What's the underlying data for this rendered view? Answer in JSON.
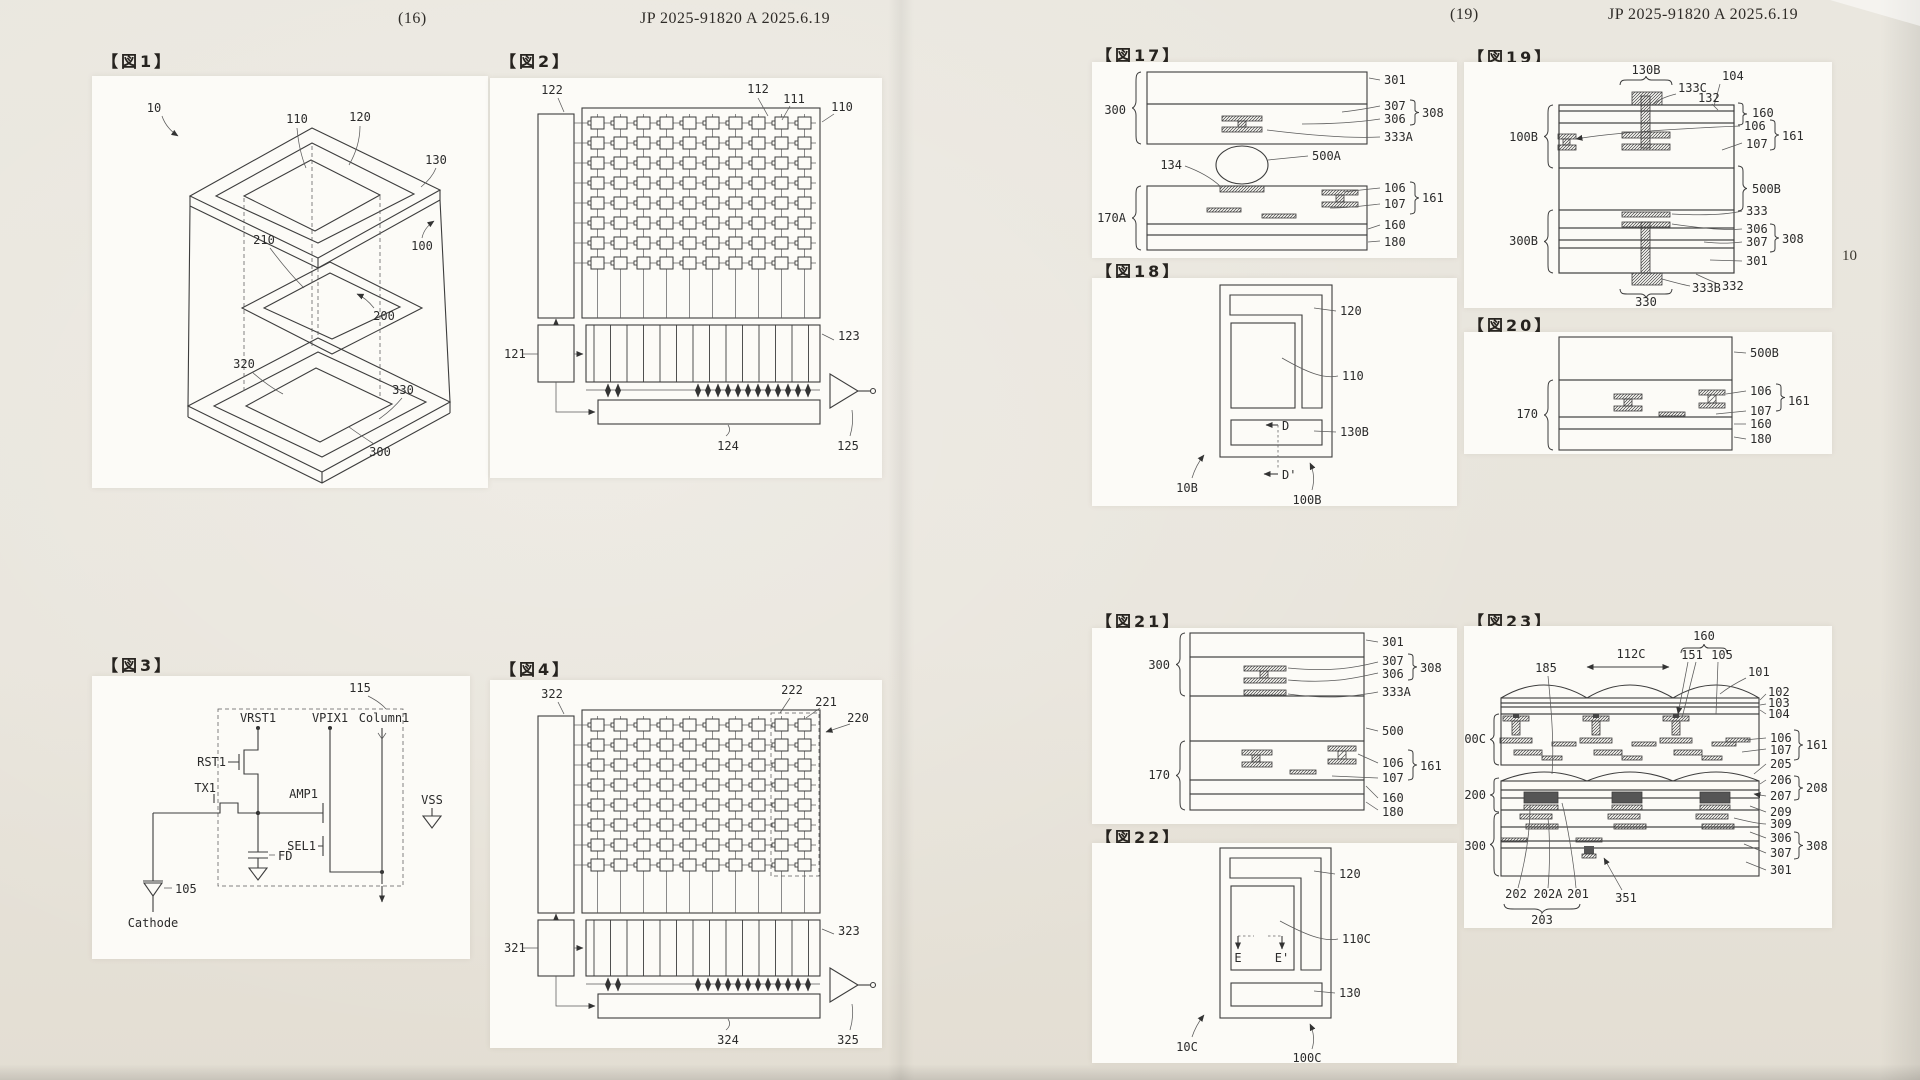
{
  "header_left": {
    "page_num": "(16)",
    "doc_id": "JP 2025-91820 A 2025.6.19"
  },
  "header_right": {
    "page_num": "(19)",
    "doc_id": "JP 2025-91820 A 2025.6.19"
  },
  "margin_note": "10",
  "figures": {
    "fig1": {
      "title": "【図1】",
      "labels": {
        "n10": "10",
        "n110": "110",
        "n120": "120",
        "n130": "130",
        "n100": "100",
        "n210": "210",
        "n200": "200",
        "n320": "320",
        "n330": "330",
        "n300": "300"
      }
    },
    "fig2": {
      "title": "【図2】",
      "labels": {
        "n122": "122",
        "n112": "112",
        "n111": "111",
        "n110": "110",
        "n121": "121",
        "n123": "123",
        "n124": "124",
        "n125": "125"
      }
    },
    "fig3": {
      "title": "【図3】",
      "labels": {
        "n115": "115",
        "vrst1": "VRST1",
        "vpix1": "VPIX1",
        "column1": "Column1",
        "rst1": "RST1",
        "tx1": "TX1",
        "amp1": "AMP1",
        "sel1": "SEL1",
        "fd": "FD",
        "vss": "VSS",
        "n105": "105",
        "cathode": "Cathode"
      }
    },
    "fig4": {
      "title": "【図4】",
      "labels": {
        "n322": "322",
        "n222": "222",
        "n221": "221",
        "n220": "220",
        "n321": "321",
        "n323": "323",
        "n324": "324",
        "n325": "325"
      }
    },
    "fig17": {
      "title": "【図17】",
      "labels": {
        "n300": "300",
        "n301": "301",
        "n307": "307",
        "n306": "306",
        "n308": "308",
        "n333A": "333A",
        "n134": "134",
        "n500A": "500A",
        "n170A": "170A",
        "n106": "106",
        "n107": "107",
        "n161": "161",
        "n160": "160",
        "n180": "180"
      }
    },
    "fig18": {
      "title": "【図18】",
      "labels": {
        "n120": "120",
        "n110": "110",
        "n130B": "130B",
        "d": "D",
        "dprime": "D'",
        "n10B": "10B",
        "n100B": "100B"
      }
    },
    "fig19": {
      "title": "【図19】",
      "labels": {
        "n130B": "130B",
        "n133C": "133C",
        "n104": "104",
        "n132": "132",
        "n160": "160",
        "n106": "106",
        "n107": "107",
        "n161": "161",
        "n100B": "100B",
        "n500B": "500B",
        "n333": "333",
        "n306": "306",
        "n307": "307",
        "n308": "308",
        "n301": "301",
        "n300B": "300B",
        "n333B": "333B",
        "n332": "332",
        "n330": "330"
      }
    },
    "fig20": {
      "title": "【図20】",
      "labels": {
        "n500B": "500B",
        "n106": "106",
        "n107": "107",
        "n161": "161",
        "n170": "170",
        "n160": "160",
        "n180": "180"
      }
    },
    "fig21": {
      "title": "【図21】",
      "labels": {
        "n300": "300",
        "n301": "301",
        "n307": "307",
        "n306": "306",
        "n308": "308",
        "n333A": "333A",
        "n500": "500",
        "n170": "170",
        "n106": "106",
        "n107": "107",
        "n161": "161",
        "n160": "160",
        "n180": "180"
      }
    },
    "fig22": {
      "title": "【図22】",
      "labels": {
        "n120": "120",
        "n110C": "110C",
        "n130": "130",
        "e": "E",
        "eprime": "E'",
        "n10C": "10C",
        "n100C": "100C"
      }
    },
    "fig23": {
      "title": "【図23】",
      "labels": {
        "n112C": "112C",
        "n160": "160",
        "n151": "151",
        "n105": "105",
        "n101": "101",
        "n185": "185",
        "n102": "102",
        "n103": "103",
        "n104": "104",
        "n100C": "100C",
        "n106": "106",
        "n107": "107",
        "n161": "161",
        "n205": "205",
        "n200": "200",
        "n206": "206",
        "n207": "207",
        "n208": "208",
        "n209": "209",
        "n309": "309",
        "n300": "300",
        "n306": "306",
        "n307": "307",
        "n308": "308",
        "n301": "301",
        "n202": "202",
        "n202A": "202A",
        "n201": "201",
        "n351": "351",
        "n203": "203"
      }
    }
  }
}
